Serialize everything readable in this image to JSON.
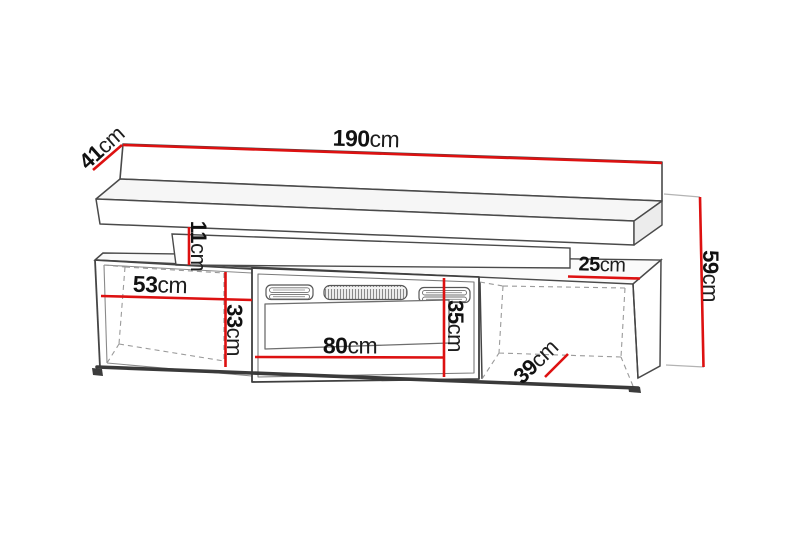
{
  "diagram": {
    "unit": "cm",
    "dimensions": {
      "total_width": {
        "value": "190",
        "unit": "cm"
      },
      "shelf_depth": {
        "value": "41",
        "unit": "cm"
      },
      "shelf_panel_height": {
        "value": "11",
        "unit": "cm"
      },
      "left_compartment_width": {
        "value": "53",
        "unit": "cm"
      },
      "left_compartment_height": {
        "value": "33",
        "unit": "cm"
      },
      "fireplace_width": {
        "value": "80",
        "unit": "cm"
      },
      "fireplace_height": {
        "value": "35",
        "unit": "cm"
      },
      "top_right_depth": {
        "value": "25",
        "unit": "cm"
      },
      "right_compartment_depth": {
        "value": "39",
        "unit": "cm"
      },
      "cabinet_height": {
        "value": "59",
        "unit": "cm"
      }
    },
    "colors": {
      "dimension_line": "#dd1111",
      "outline": "#4a4a4a",
      "background": "#ffffff",
      "text": "#111111"
    }
  }
}
